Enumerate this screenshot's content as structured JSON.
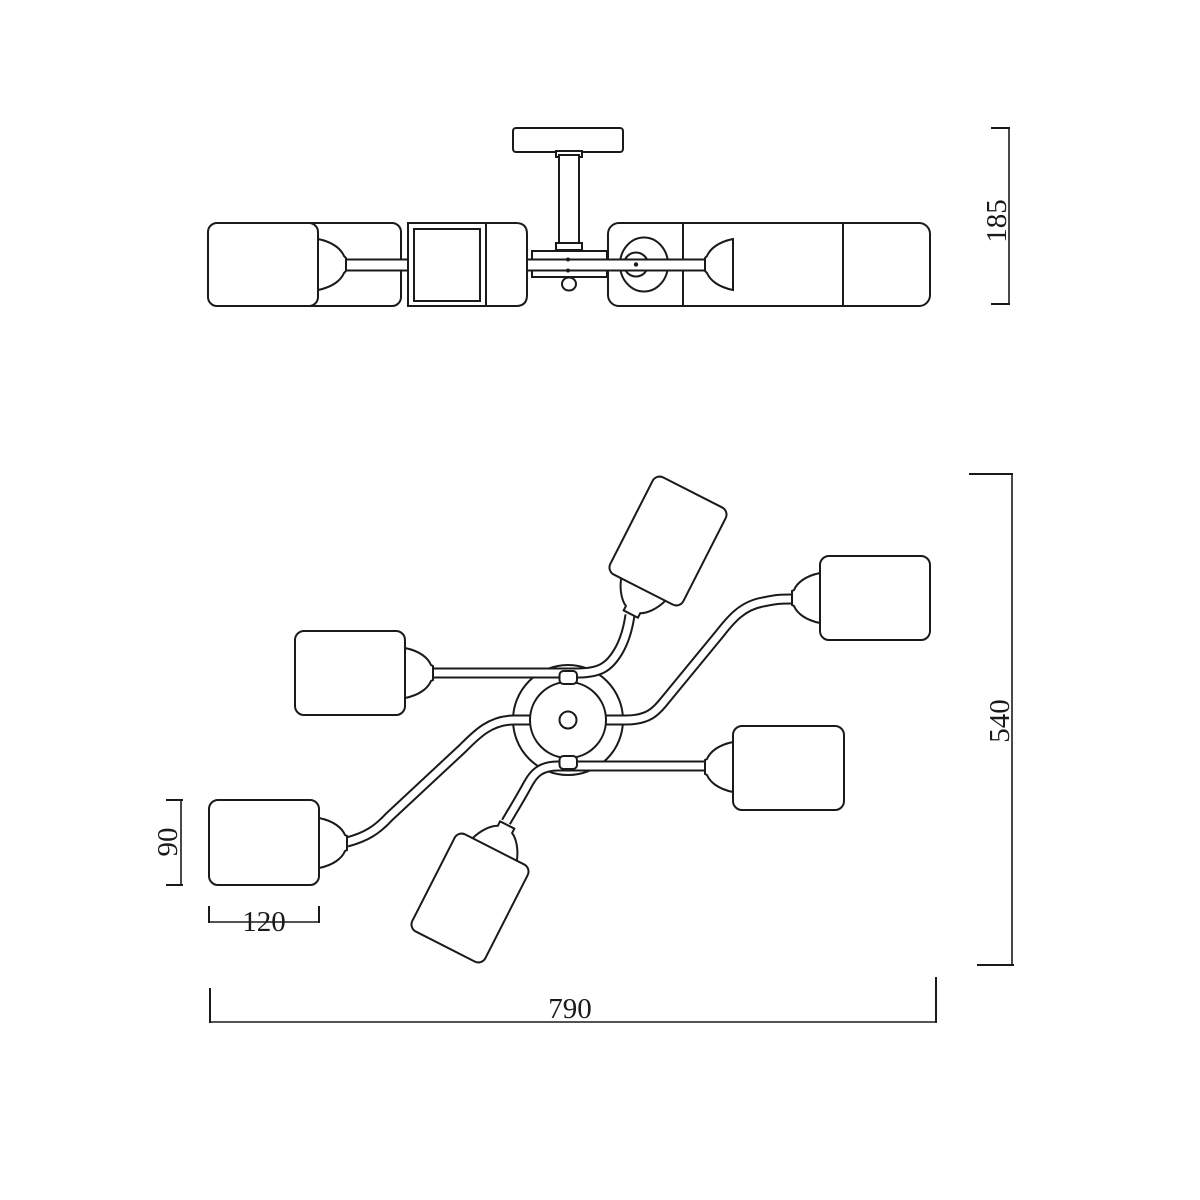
{
  "dims": {
    "fixture_height": "185",
    "fixture_width": "790",
    "fixture_depth": "540",
    "shade_width": "120",
    "shade_depth": "90"
  }
}
